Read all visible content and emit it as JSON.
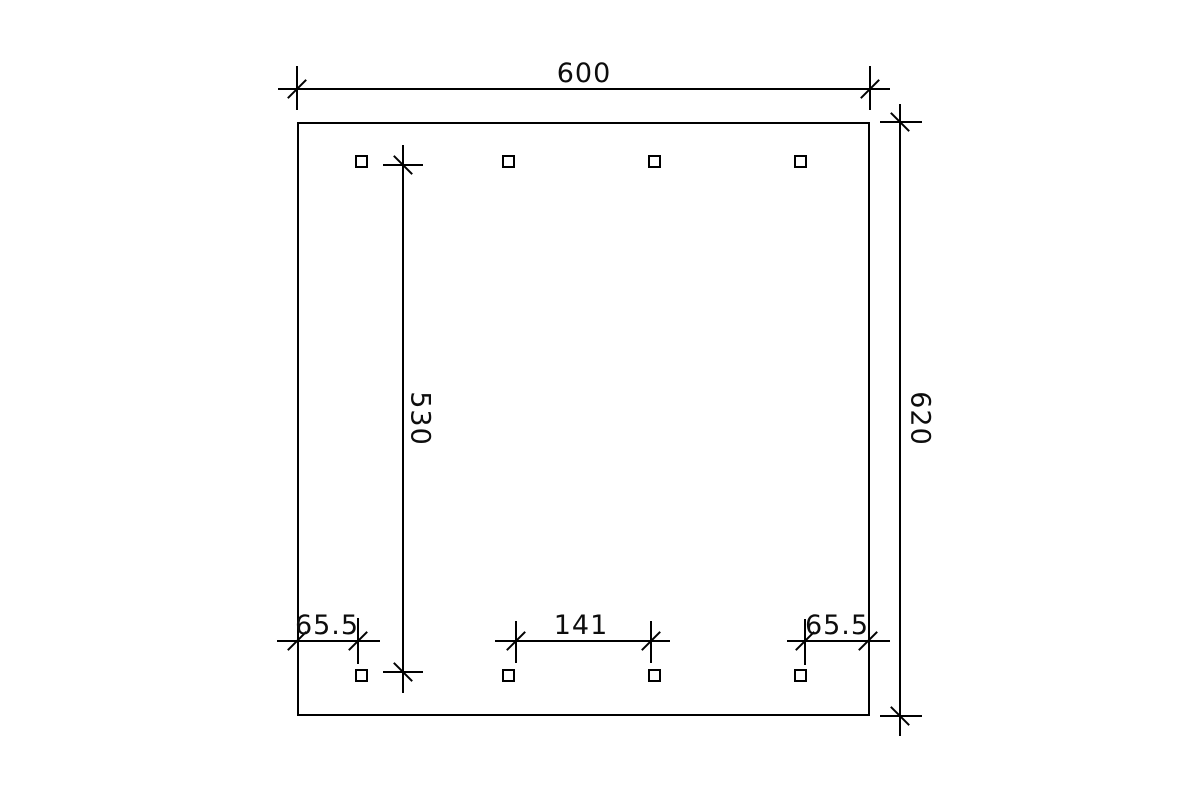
{
  "canvas": {
    "background": "#ffffff",
    "line_color": "#000000"
  },
  "drawing": {
    "type": "technical-plan",
    "object": "rectangular layout with eight square posts (two rows of four)",
    "dimensions": {
      "top_width": {
        "value": "600"
      },
      "right_height": {
        "value": "620"
      },
      "inner_vertical": {
        "value": "530"
      },
      "bottom_left_offset": {
        "value": "65.5"
      },
      "bottom_center_spacing": {
        "value": "141"
      },
      "bottom_right_offset": {
        "value": "65.5"
      }
    },
    "posts": {
      "count": 8,
      "rows": 2,
      "per_row": 4
    }
  }
}
